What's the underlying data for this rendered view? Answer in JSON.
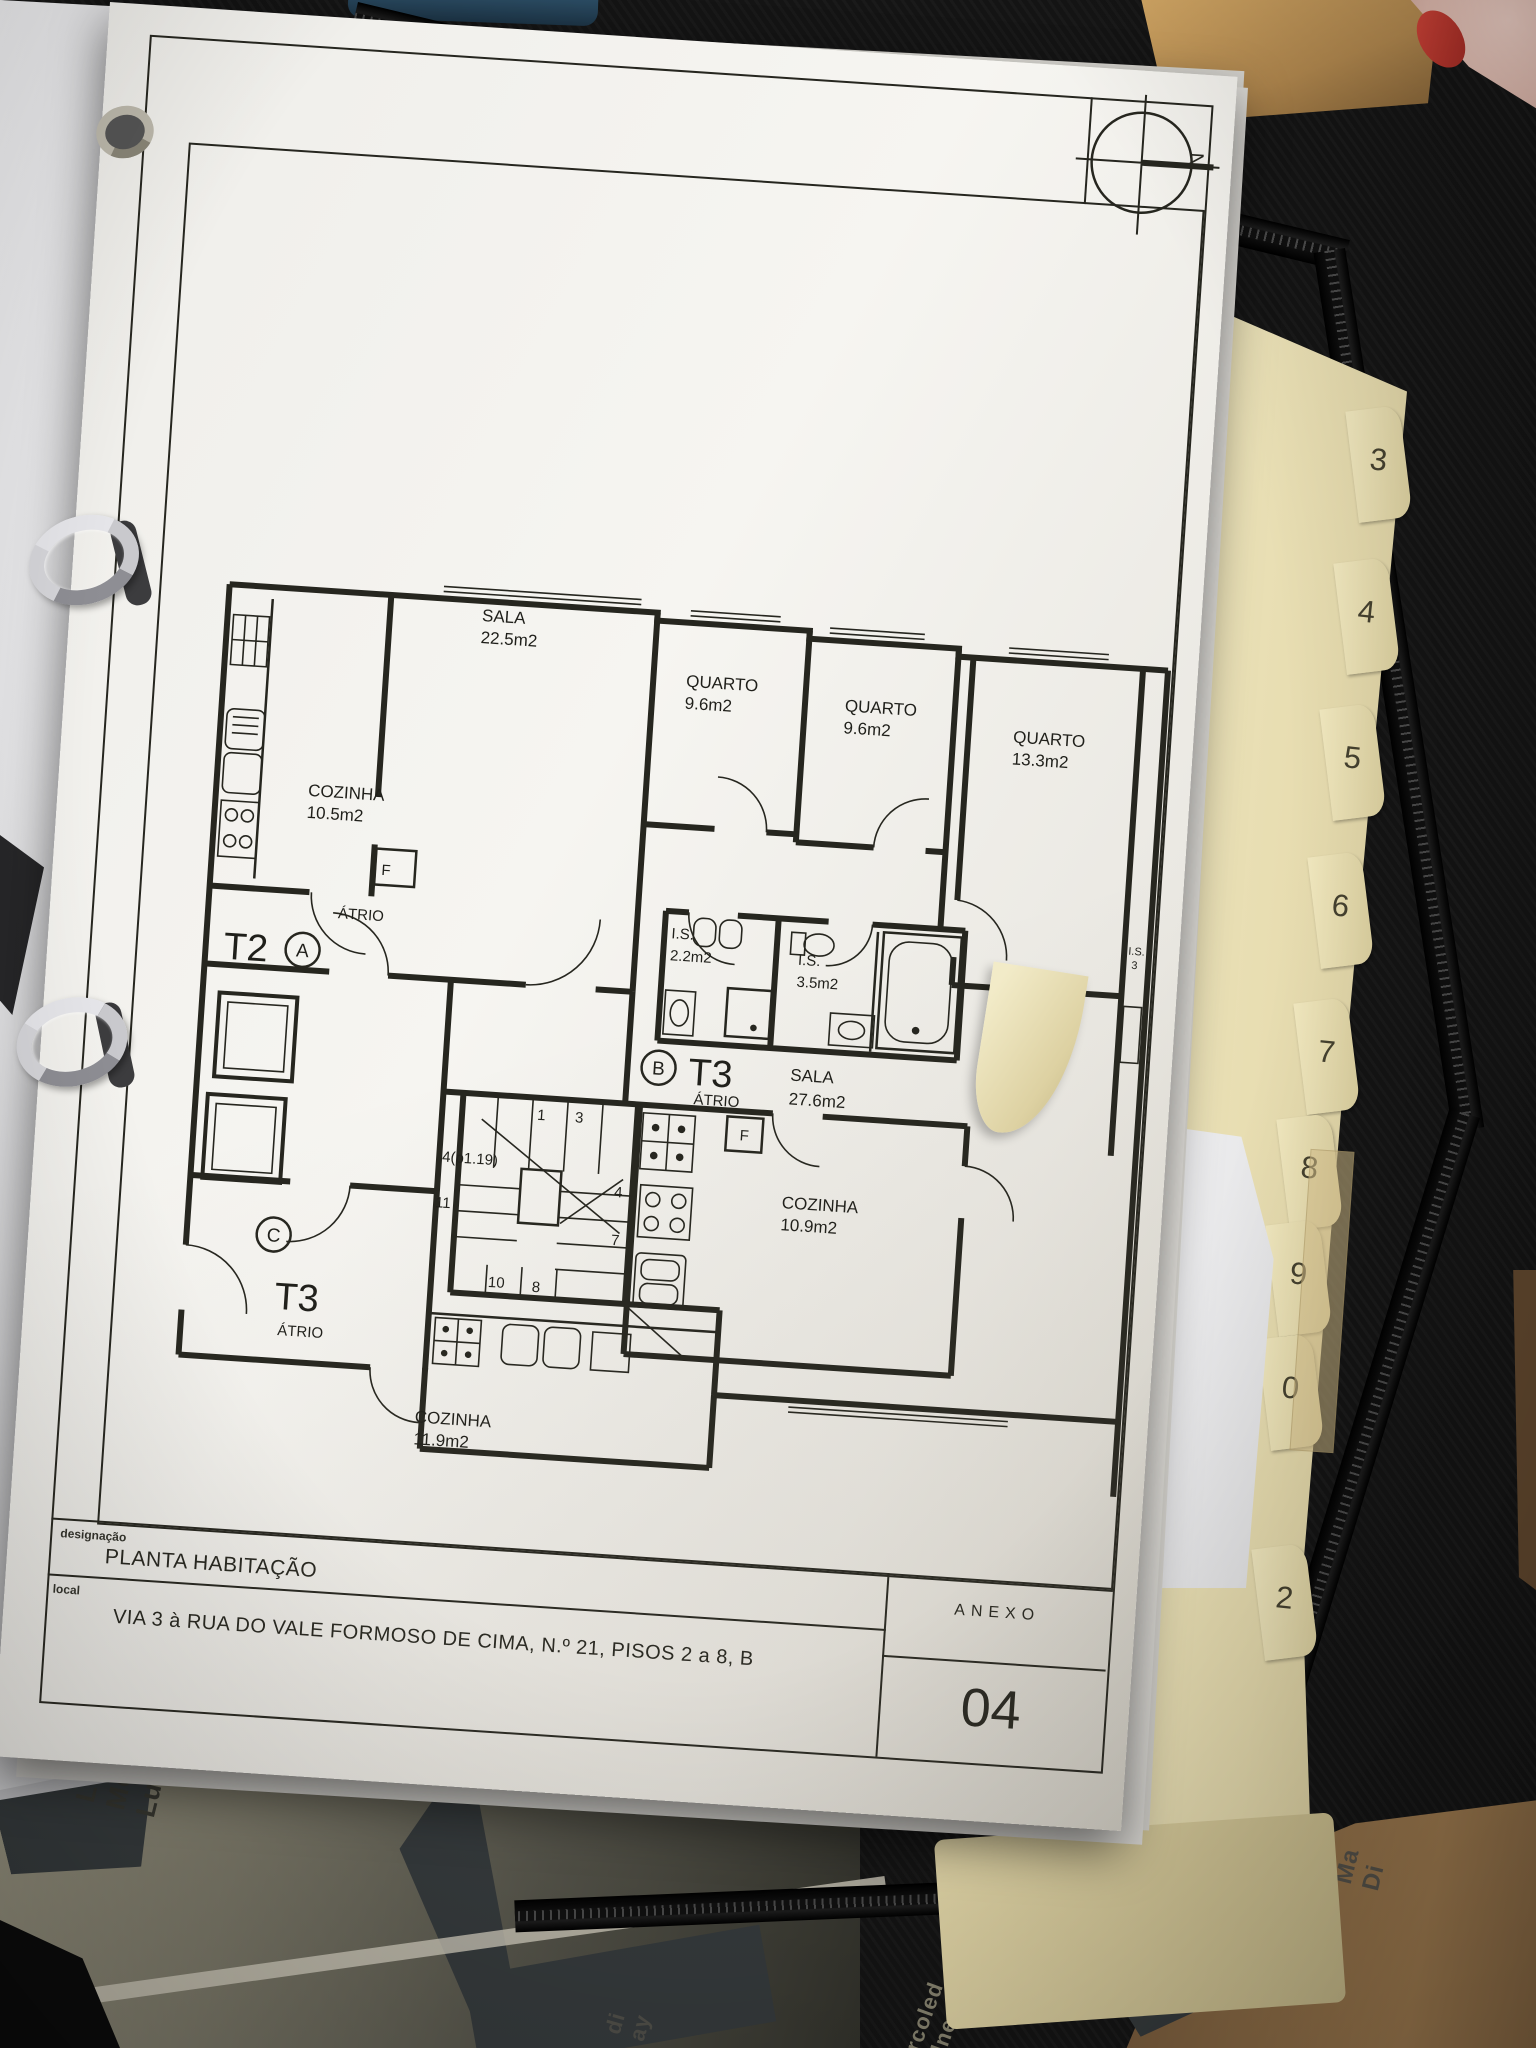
{
  "titleblock": {
    "designacao_label": "designação",
    "designacao_value": "PLANTA HABITAÇÃO",
    "local_label": "local",
    "local_value": "VIA 3 à RUA DO VALE FORMOSO DE CIMA, N.º 21, PISOS 2 a 8, B",
    "anexo_label": "ANEXO",
    "anexo_number": "04"
  },
  "plan": {
    "north": "N",
    "fridge": "F",
    "unit_a": {
      "type": "T2",
      "letter": "A",
      "atrio": "ÁTRIO"
    },
    "unit_b": {
      "type": "T3",
      "letter": "B",
      "atrio": "ÁTRIO"
    },
    "unit_c": {
      "type": "T3",
      "letter": "C",
      "atrio": "ÁTRIO"
    },
    "rooms": {
      "sala_a": {
        "name": "SALA",
        "area": "22.5m2"
      },
      "quarto_1": {
        "name": "QUARTO",
        "area": "9.6m2"
      },
      "quarto_2": {
        "name": "QUARTO",
        "area": "9.6m2"
      },
      "quarto_3": {
        "name": "QUARTO",
        "area": "13.3m2"
      },
      "cozinha_a": {
        "name": "COZINHA",
        "area": "10.5m2"
      },
      "is_1": {
        "name": "I.S.",
        "area": "2.2m2"
      },
      "is_2": {
        "name": "I.S.",
        "area": "3.5m2"
      },
      "is_3": {
        "name": "I.S.",
        "area": "3"
      },
      "sala_b": {
        "name": "SALA",
        "area": "27.6m2"
      },
      "cozinha_b": {
        "name": "COZINHA",
        "area": "10.9m2"
      },
      "cozinha_c": {
        "name": "COZINHA",
        "area": "11.9m2"
      }
    },
    "stairs": [
      "1",
      "3",
      "4(p1.19)",
      "4",
      "11",
      "7",
      "10",
      "8"
    ]
  },
  "binder": {
    "tabs": [
      "3",
      "4",
      "5",
      "6",
      "7",
      "8",
      "9",
      "0",
      "2"
    ]
  },
  "desk": {
    "words_left": [
      "Lundi",
      "Montag",
      "Lunes"
    ],
    "words_right": [
      "Ma",
      "Di",
      "di",
      "ay"
    ],
    "words_bottom": [
      "rcoled",
      "dnes"
    ]
  }
}
